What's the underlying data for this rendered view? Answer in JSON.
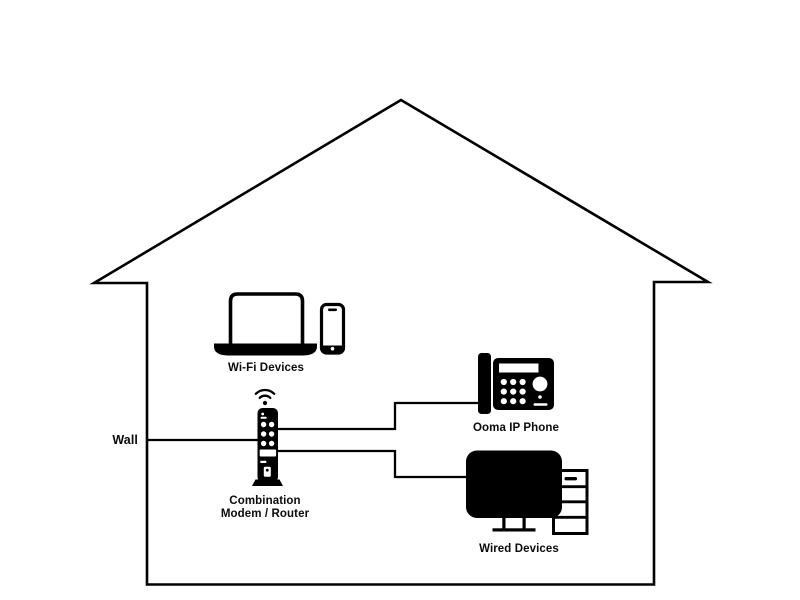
{
  "diagram": {
    "labels": {
      "wall": "Wall",
      "wifi_devices": "Wi-Fi Devices",
      "modem_line1": "Combination",
      "modem_line2": "Modem / Router",
      "ip_phone": "Ooma IP Phone",
      "wired_devices": "Wired Devices"
    },
    "colors": {
      "ink": "#000000",
      "background": "#ffffff"
    },
    "nodes": [
      {
        "id": "wall",
        "label": "Wall"
      },
      {
        "id": "modem-router",
        "label": "Combination Modem / Router"
      },
      {
        "id": "wifi-devices",
        "label": "Wi-Fi Devices"
      },
      {
        "id": "ooma-ip-phone",
        "label": "Ooma IP Phone"
      },
      {
        "id": "wired-devices",
        "label": "Wired Devices"
      }
    ],
    "connections": [
      {
        "from": "wall",
        "to": "modem-router",
        "type": "wired"
      },
      {
        "from": "modem-router",
        "to": "ooma-ip-phone",
        "type": "wired"
      },
      {
        "from": "modem-router",
        "to": "wired-devices",
        "type": "wired"
      },
      {
        "from": "modem-router",
        "to": "wifi-devices",
        "type": "wireless"
      }
    ]
  }
}
